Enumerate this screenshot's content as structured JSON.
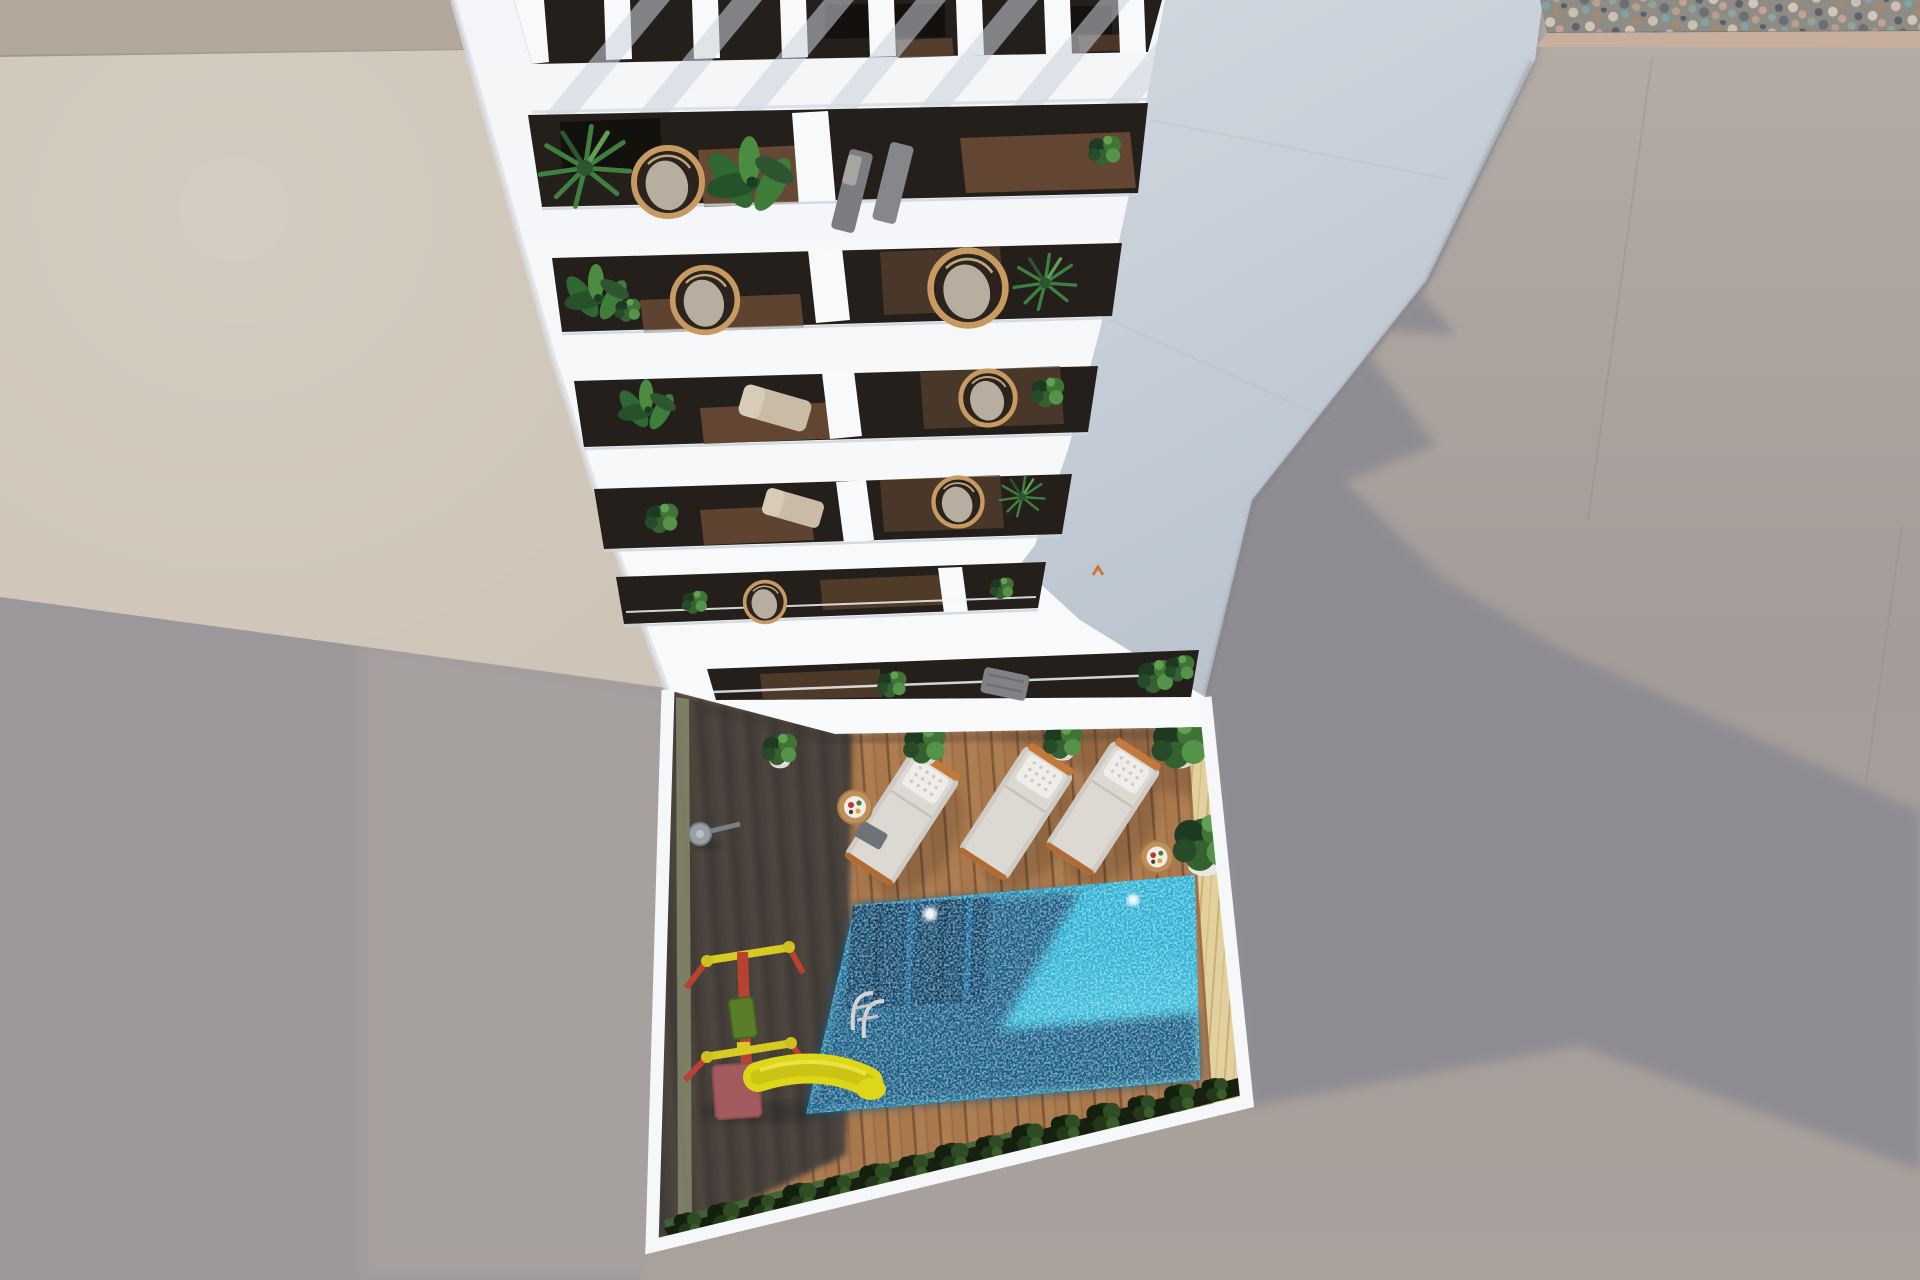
{
  "meta": {
    "title": "Aerial 3D architectural rendering",
    "description": "Top-down aerial visualization of a white residential apartment building with a slatted rooftop pergola, six stacked balcony rows furnished with plants and wicker chairs, and a ground-floor courtyard containing a swimming pool, three sun loungers, side tables, potted plants and a children's playground with a yellow slide. Surrounding grounds show concrete paving, a gravel strip and the building's cast shadow.",
    "image_type": "3d-render",
    "camera": "top-down aerial"
  },
  "scene": {
    "building": {
      "label": "white-apartment-building",
      "balcony_rows": 6,
      "pergola_slat_count": 7,
      "features": [
        "rooftop-pergola",
        "stacked-balconies",
        "white-parapets",
        "dark-wood-balcony-floors"
      ]
    },
    "courtyard": {
      "label": "pool-courtyard",
      "pool": {
        "label": "swimming-pool",
        "skimmer_dots": 2,
        "has_steps": true,
        "has_ladder": true
      },
      "loungers": {
        "count": 3,
        "style": "white-cushion-tufted-pillow"
      },
      "tables": {
        "count": 2,
        "style": "round-wood-with-tray"
      },
      "planters": {
        "count": 5
      },
      "playground": {
        "label": "kids-playground",
        "items": [
          "swing-frame",
          "yellow-slide",
          "platform-box"
        ]
      },
      "hedge": {
        "label": "perimeter-hedge"
      },
      "deck": {
        "label": "timber-deck",
        "zones": [
          "shadowed-dark",
          "sunlit-brown"
        ]
      }
    },
    "surroundings": {
      "top_left": "beige-neighbor-roof",
      "bottom_left": "gray-neighbor-walls",
      "right": "concrete-ground-with-building-shadow",
      "top_right": "gravel-strip-with-tan-border"
    }
  },
  "colors": {
    "bg_wall_left": "#9b979a",
    "bg_wall_left_light": "#a8a1a0",
    "roof_strip": "#b1a79a",
    "roof_beige": "#cec4b7",
    "ground_warm": "#a7a09b",
    "shadow_cast": "#8c8b93",
    "east_face_top": "#d1d8e0",
    "east_face_bottom": "#b9c3ce",
    "gravel_bg": "#8f8b85",
    "tan_border": "#c7ae9d",
    "front_white": "#f5f7f9",
    "pillar_white": "#f7f9fb",
    "balcony_dark": "#241f1b",
    "balcony_wood": "#6d4e36",
    "deck_lit": "#a9784c",
    "deck_dark": "#463f3a",
    "tan_wall_face": "#e2d19e",
    "pool_bright": "#28b0d4",
    "pool_dark": "#14567f",
    "pool_steps": "#0d456b",
    "hedge_dark": "#17200f",
    "grass_green": "#3f6434",
    "olive_strip": "#85896b",
    "lounger_cushion": "#dcd8d2",
    "lounger_pillow": "#efedea",
    "lounger_frame_orange": "#c27a3c",
    "table_wood": "#c0905a",
    "tray_white": "#f0ede8",
    "pot_white": "#eae7e2",
    "slide_yellow": "#ded618",
    "frame_red": "#b8412f",
    "bar_yellow": "#d8ca22",
    "platform_mauve": "#a35a5e",
    "seat_green": "#5a7d2a",
    "plant_green_mid": "#2d5530",
    "plant_green_light": "#55924a",
    "wicker_tan": "#c79a62",
    "chair_gray": "#7b7d80",
    "marker_orange": "#c77933"
  }
}
